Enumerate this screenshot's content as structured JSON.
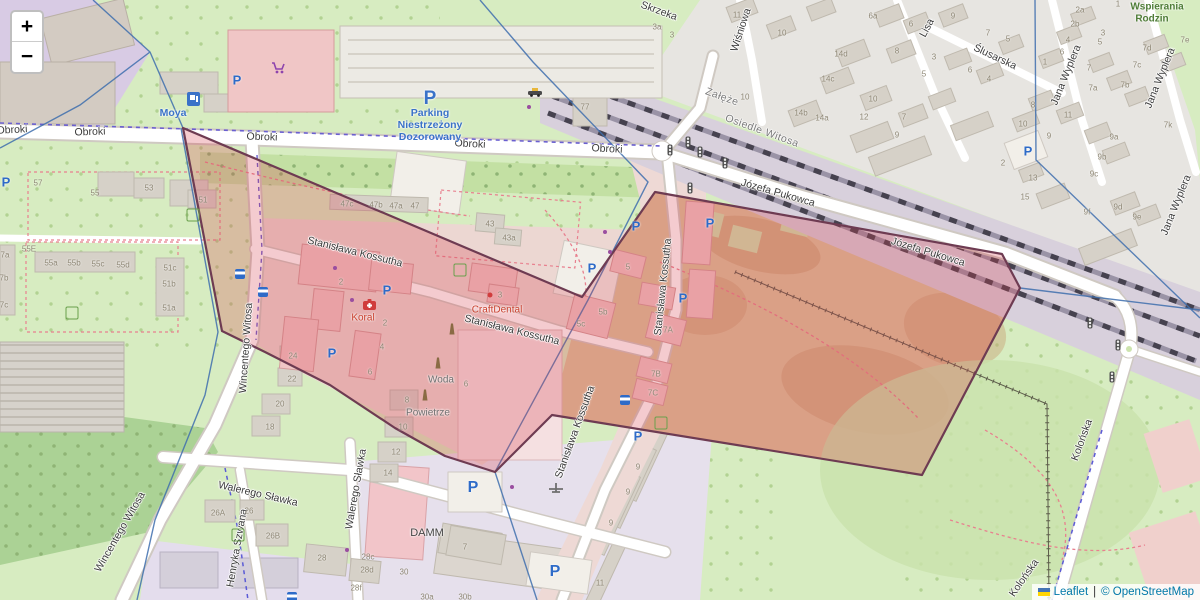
{
  "controls": {
    "zoom_in": "+",
    "zoom_out": "−"
  },
  "attribution": {
    "leaflet": "Leaflet",
    "separator": "|",
    "copyright": "© OpenStreetMap"
  },
  "colors": {
    "overlay_fill": "#d53e4f",
    "overlay_stroke": "#6e3b52",
    "admin_line": "#3f6fae",
    "parking_blue": "#2e6bc8",
    "poi_red": "#c9402e",
    "grass": "#d7ecc1",
    "allotment_tan": "#dcc49c",
    "railway_band": "#d8d0dc",
    "urban_gray": "#e7e5e1",
    "campus_purple": "#d8cbe4",
    "industrial": "#e4dded"
  },
  "map": {
    "street_labels": [
      {
        "t": "Obroki",
        "x": 12,
        "y": 130,
        "r": -3
      },
      {
        "t": "Obroki",
        "x": 90,
        "y": 132,
        "r": -2
      },
      {
        "t": "Obroki",
        "x": 262,
        "y": 137,
        "r": 2
      },
      {
        "t": "Obroki",
        "x": 470,
        "y": 144,
        "r": 3
      },
      {
        "t": "Obroki",
        "x": 607,
        "y": 149,
        "r": 3
      },
      {
        "t": "Stanisława Kossutha",
        "x": 355,
        "y": 252,
        "r": 14
      },
      {
        "t": "Stanisława Kossutha",
        "x": 512,
        "y": 330,
        "r": 14
      },
      {
        "t": "Stanisława Kossutha",
        "x": 663,
        "y": 287,
        "r": -84
      },
      {
        "t": "Stanisława Kossutha",
        "x": 575,
        "y": 432,
        "r": -70
      },
      {
        "t": "Józefa Pukowca",
        "x": 778,
        "y": 193,
        "r": 16
      },
      {
        "t": "Józefa Pukowca",
        "x": 928,
        "y": 252,
        "r": 17
      },
      {
        "t": "Wincentego Witosa",
        "x": 246,
        "y": 348,
        "r": -86
      },
      {
        "t": "Wincentego Witosa",
        "x": 120,
        "y": 532,
        "r": -60
      },
      {
        "t": "Walerego Sławka",
        "x": 258,
        "y": 494,
        "r": 13
      },
      {
        "t": "Walerego Sławka",
        "x": 356,
        "y": 489,
        "r": -80
      },
      {
        "t": "Henryka Szwana",
        "x": 237,
        "y": 548,
        "r": -80
      },
      {
        "t": "Lisa",
        "x": 927,
        "y": 28,
        "r": -62
      },
      {
        "t": "Ślusarska",
        "x": 995,
        "y": 57,
        "r": 25
      },
      {
        "t": "Jana Wyplera",
        "x": 1066,
        "y": 75,
        "r": -68
      },
      {
        "t": "Jana Wyplera",
        "x": 1160,
        "y": 78,
        "r": -68
      },
      {
        "t": "Jana Wyplera",
        "x": 1176,
        "y": 205,
        "r": -68
      },
      {
        "t": "Wiśniowa",
        "x": 741,
        "y": 30,
        "r": -72
      },
      {
        "t": "Skrzeka",
        "x": 659,
        "y": 11,
        "r": 20
      },
      {
        "t": "Kolońska",
        "x": 1082,
        "y": 440,
        "r": -70
      },
      {
        "t": "Kolońska",
        "x": 1024,
        "y": 578,
        "r": -55
      }
    ],
    "area_labels": [
      {
        "t": "Załęże",
        "x": 722,
        "y": 97,
        "r": 20
      },
      {
        "t": "Osiedle Witosa",
        "x": 762,
        "y": 131,
        "r": 20
      }
    ],
    "poi_labels": [
      {
        "t": "Moya",
        "x": 173,
        "y": 113,
        "k": "blue"
      },
      {
        "t": "P",
        "x": 430,
        "y": 99,
        "k": "bigp"
      },
      {
        "t": "Parking",
        "x": 430,
        "y": 113,
        "k": "blue"
      },
      {
        "t": "Niestrzeżony",
        "x": 430,
        "y": 125,
        "k": "blue"
      },
      {
        "t": "Dozorowany",
        "x": 430,
        "y": 137,
        "k": "blue"
      },
      {
        "t": "Koral",
        "x": 363,
        "y": 318,
        "k": "red"
      },
      {
        "t": "CraftDental",
        "x": 497,
        "y": 310,
        "k": "red"
      },
      {
        "t": "Woda",
        "x": 441,
        "y": 380,
        "k": "gray"
      },
      {
        "t": "Powietrze",
        "x": 428,
        "y": 413,
        "k": "gray"
      },
      {
        "t": "DAMM",
        "x": 427,
        "y": 533,
        "k": "dark"
      },
      {
        "t": "Wspierania",
        "x": 1157,
        "y": 7,
        "k": "green"
      },
      {
        "t": "Rodzin",
        "x": 1152,
        "y": 19,
        "k": "green"
      }
    ],
    "house_numbers": [
      {
        "t": "57",
        "x": 38,
        "y": 183
      },
      {
        "t": "55",
        "x": 95,
        "y": 193
      },
      {
        "t": "53",
        "x": 149,
        "y": 188
      },
      {
        "t": "55E",
        "x": 29,
        "y": 249
      },
      {
        "t": "55a",
        "x": 51,
        "y": 263
      },
      {
        "t": "55b",
        "x": 74,
        "y": 263
      },
      {
        "t": "55c",
        "x": 98,
        "y": 264
      },
      {
        "t": "55d",
        "x": 123,
        "y": 265
      },
      {
        "t": "51c",
        "x": 170,
        "y": 268
      },
      {
        "t": "51b",
        "x": 169,
        "y": 284
      },
      {
        "t": "51a",
        "x": 169,
        "y": 308
      },
      {
        "t": "7a",
        "x": 5,
        "y": 255
      },
      {
        "t": "7b",
        "x": 4,
        "y": 278
      },
      {
        "t": "7c",
        "x": 4,
        "y": 305
      },
      {
        "t": "51",
        "x": 203,
        "y": 200
      },
      {
        "t": "47c",
        "x": 347,
        "y": 204
      },
      {
        "t": "47b",
        "x": 376,
        "y": 205
      },
      {
        "t": "47a",
        "x": 396,
        "y": 206
      },
      {
        "t": "47",
        "x": 415,
        "y": 206
      },
      {
        "t": "43",
        "x": 490,
        "y": 224
      },
      {
        "t": "43a",
        "x": 509,
        "y": 238
      },
      {
        "t": "77",
        "x": 585,
        "y": 107
      },
      {
        "t": "2",
        "x": 341,
        "y": 282
      },
      {
        "t": "2",
        "x": 385,
        "y": 323
      },
      {
        "t": "4",
        "x": 382,
        "y": 347
      },
      {
        "t": "6",
        "x": 370,
        "y": 372
      },
      {
        "t": "24",
        "x": 293,
        "y": 356
      },
      {
        "t": "22",
        "x": 292,
        "y": 379
      },
      {
        "t": "20",
        "x": 280,
        "y": 404
      },
      {
        "t": "18",
        "x": 270,
        "y": 427
      },
      {
        "t": "8",
        "x": 407,
        "y": 400
      },
      {
        "t": "10",
        "x": 403,
        "y": 427
      },
      {
        "t": "12",
        "x": 396,
        "y": 452
      },
      {
        "t": "14",
        "x": 388,
        "y": 473
      },
      {
        "t": "5",
        "x": 628,
        "y": 267
      },
      {
        "t": "5b",
        "x": 603,
        "y": 312
      },
      {
        "t": "5c",
        "x": 581,
        "y": 324
      },
      {
        "t": "6",
        "x": 466,
        "y": 384
      },
      {
        "t": "3",
        "x": 500,
        "y": 295
      },
      {
        "t": "7A",
        "x": 668,
        "y": 330
      },
      {
        "t": "7B",
        "x": 656,
        "y": 374
      },
      {
        "t": "7C",
        "x": 653,
        "y": 393
      },
      {
        "t": "26A",
        "x": 218,
        "y": 513
      },
      {
        "t": "26",
        "x": 249,
        "y": 511
      },
      {
        "t": "26B",
        "x": 273,
        "y": 536
      },
      {
        "t": "28",
        "x": 322,
        "y": 558
      },
      {
        "t": "28c",
        "x": 368,
        "y": 557
      },
      {
        "t": "28d",
        "x": 367,
        "y": 570
      },
      {
        "t": "28f",
        "x": 356,
        "y": 588
      },
      {
        "t": "30",
        "x": 404,
        "y": 572
      },
      {
        "t": "30a",
        "x": 427,
        "y": 597
      },
      {
        "t": "30b",
        "x": 465,
        "y": 597
      },
      {
        "t": "7",
        "x": 465,
        "y": 547
      },
      {
        "t": "9",
        "x": 638,
        "y": 467
      },
      {
        "t": "9",
        "x": 628,
        "y": 492
      },
      {
        "t": "9",
        "x": 611,
        "y": 523
      },
      {
        "t": "11",
        "x": 600,
        "y": 583
      },
      {
        "t": "11",
        "x": 737,
        "y": 15
      },
      {
        "t": "10",
        "x": 782,
        "y": 33
      },
      {
        "t": "10",
        "x": 745,
        "y": 97
      },
      {
        "t": "3a",
        "x": 657,
        "y": 27
      },
      {
        "t": "3",
        "x": 672,
        "y": 35
      },
      {
        "t": "6a",
        "x": 873,
        "y": 16
      },
      {
        "t": "6",
        "x": 911,
        "y": 24
      },
      {
        "t": "9",
        "x": 953,
        "y": 16
      },
      {
        "t": "7",
        "x": 988,
        "y": 33
      },
      {
        "t": "5",
        "x": 1008,
        "y": 39
      },
      {
        "t": "8",
        "x": 897,
        "y": 51
      },
      {
        "t": "14d",
        "x": 841,
        "y": 54
      },
      {
        "t": "3",
        "x": 934,
        "y": 57
      },
      {
        "t": "5",
        "x": 924,
        "y": 74
      },
      {
        "t": "6",
        "x": 970,
        "y": 70
      },
      {
        "t": "4",
        "x": 989,
        "y": 79
      },
      {
        "t": "14c",
        "x": 828,
        "y": 79
      },
      {
        "t": "10",
        "x": 873,
        "y": 99
      },
      {
        "t": "12",
        "x": 864,
        "y": 117
      },
      {
        "t": "7",
        "x": 904,
        "y": 117
      },
      {
        "t": "9",
        "x": 897,
        "y": 135
      },
      {
        "t": "14b",
        "x": 801,
        "y": 113
      },
      {
        "t": "14a",
        "x": 822,
        "y": 118
      },
      {
        "t": "2a",
        "x": 1080,
        "y": 10
      },
      {
        "t": "2b",
        "x": 1075,
        "y": 24
      },
      {
        "t": "4",
        "x": 1068,
        "y": 40
      },
      {
        "t": "6",
        "x": 1062,
        "y": 52
      },
      {
        "t": "1",
        "x": 1045,
        "y": 62
      },
      {
        "t": "1",
        "x": 1118,
        "y": 4
      },
      {
        "t": "3",
        "x": 1103,
        "y": 33
      },
      {
        "t": "5",
        "x": 1100,
        "y": 42
      },
      {
        "t": "7",
        "x": 1089,
        "y": 68
      },
      {
        "t": "7e",
        "x": 1185,
        "y": 40
      },
      {
        "t": "7d",
        "x": 1147,
        "y": 48
      },
      {
        "t": "7c",
        "x": 1137,
        "y": 65
      },
      {
        "t": "7b",
        "x": 1125,
        "y": 85
      },
      {
        "t": "7a",
        "x": 1093,
        "y": 88
      },
      {
        "t": "8",
        "x": 1033,
        "y": 105
      },
      {
        "t": "10",
        "x": 1023,
        "y": 124
      },
      {
        "t": "11",
        "x": 1068,
        "y": 115
      },
      {
        "t": "9",
        "x": 1049,
        "y": 136
      },
      {
        "t": "9a",
        "x": 1114,
        "y": 137
      },
      {
        "t": "9b",
        "x": 1102,
        "y": 157
      },
      {
        "t": "9c",
        "x": 1094,
        "y": 174
      },
      {
        "t": "9d",
        "x": 1118,
        "y": 207
      },
      {
        "t": "9e",
        "x": 1137,
        "y": 217
      },
      {
        "t": "9f",
        "x": 1087,
        "y": 212
      },
      {
        "t": "13",
        "x": 1033,
        "y": 178
      },
      {
        "t": "15",
        "x": 1025,
        "y": 197
      },
      {
        "t": "2",
        "x": 1003,
        "y": 163
      },
      {
        "t": "7k",
        "x": 1168,
        "y": 125
      }
    ],
    "icons": [
      {
        "k": "parking",
        "t": "P",
        "x": 237,
        "y": 80
      },
      {
        "k": "parking",
        "t": "P",
        "x": 6,
        "y": 182
      },
      {
        "k": "parking",
        "t": "P",
        "x": 387,
        "y": 290
      },
      {
        "k": "parking",
        "t": "P",
        "x": 332,
        "y": 353
      },
      {
        "k": "parking",
        "t": "P",
        "x": 592,
        "y": 268
      },
      {
        "k": "parking",
        "t": "P",
        "x": 636,
        "y": 226
      },
      {
        "k": "parking",
        "t": "P",
        "x": 710,
        "y": 223
      },
      {
        "k": "parking",
        "t": "P",
        "x": 683,
        "y": 298
      },
      {
        "k": "parking",
        "t": "P",
        "x": 638,
        "y": 436
      },
      {
        "k": "parking",
        "t": "P",
        "x": 555,
        "y": 572,
        "s": 16
      },
      {
        "k": "parking",
        "t": "P",
        "x": 473,
        "y": 488,
        "s": 16
      },
      {
        "k": "parking",
        "t": "P",
        "x": 1028,
        "y": 151
      },
      {
        "k": "playground",
        "x": 193,
        "y": 215
      },
      {
        "k": "playground",
        "x": 72,
        "y": 313
      },
      {
        "k": "playground",
        "x": 238,
        "y": 535
      },
      {
        "k": "playground",
        "x": 460,
        "y": 270
      },
      {
        "k": "playground",
        "x": 661,
        "y": 423
      },
      {
        "k": "obelisk",
        "x": 452,
        "y": 329
      },
      {
        "k": "obelisk",
        "x": 438,
        "y": 363
      },
      {
        "k": "obelisk",
        "x": 425,
        "y": 395
      },
      {
        "k": "traffic_light",
        "x": 670,
        "y": 150
      },
      {
        "k": "traffic_light",
        "x": 688,
        "y": 142
      },
      {
        "k": "traffic_light",
        "x": 700,
        "y": 152
      },
      {
        "k": "traffic_light",
        "x": 725,
        "y": 163
      },
      {
        "k": "traffic_light",
        "x": 690,
        "y": 188
      },
      {
        "k": "traffic_light",
        "x": 1090,
        "y": 323
      },
      {
        "k": "traffic_light",
        "x": 1118,
        "y": 345
      },
      {
        "k": "traffic_light",
        "x": 1112,
        "y": 377
      },
      {
        "k": "bus_stop",
        "x": 240,
        "y": 274
      },
      {
        "k": "bus_stop",
        "x": 263,
        "y": 292
      },
      {
        "k": "bus_stop",
        "x": 625,
        "y": 400
      },
      {
        "k": "bus_stop",
        "x": 292,
        "y": 597
      },
      {
        "k": "dot_red",
        "x": 490,
        "y": 295
      },
      {
        "k": "dot_purple",
        "x": 529,
        "y": 107
      },
      {
        "k": "dot_purple",
        "x": 512,
        "y": 487
      },
      {
        "k": "dot_purple",
        "x": 347,
        "y": 550
      },
      {
        "k": "dot_purple",
        "x": 335,
        "y": 268
      },
      {
        "k": "dot_purple",
        "x": 352,
        "y": 300
      },
      {
        "k": "dot_purple",
        "x": 605,
        "y": 232
      },
      {
        "k": "dot_purple",
        "x": 610,
        "y": 252
      }
    ]
  }
}
